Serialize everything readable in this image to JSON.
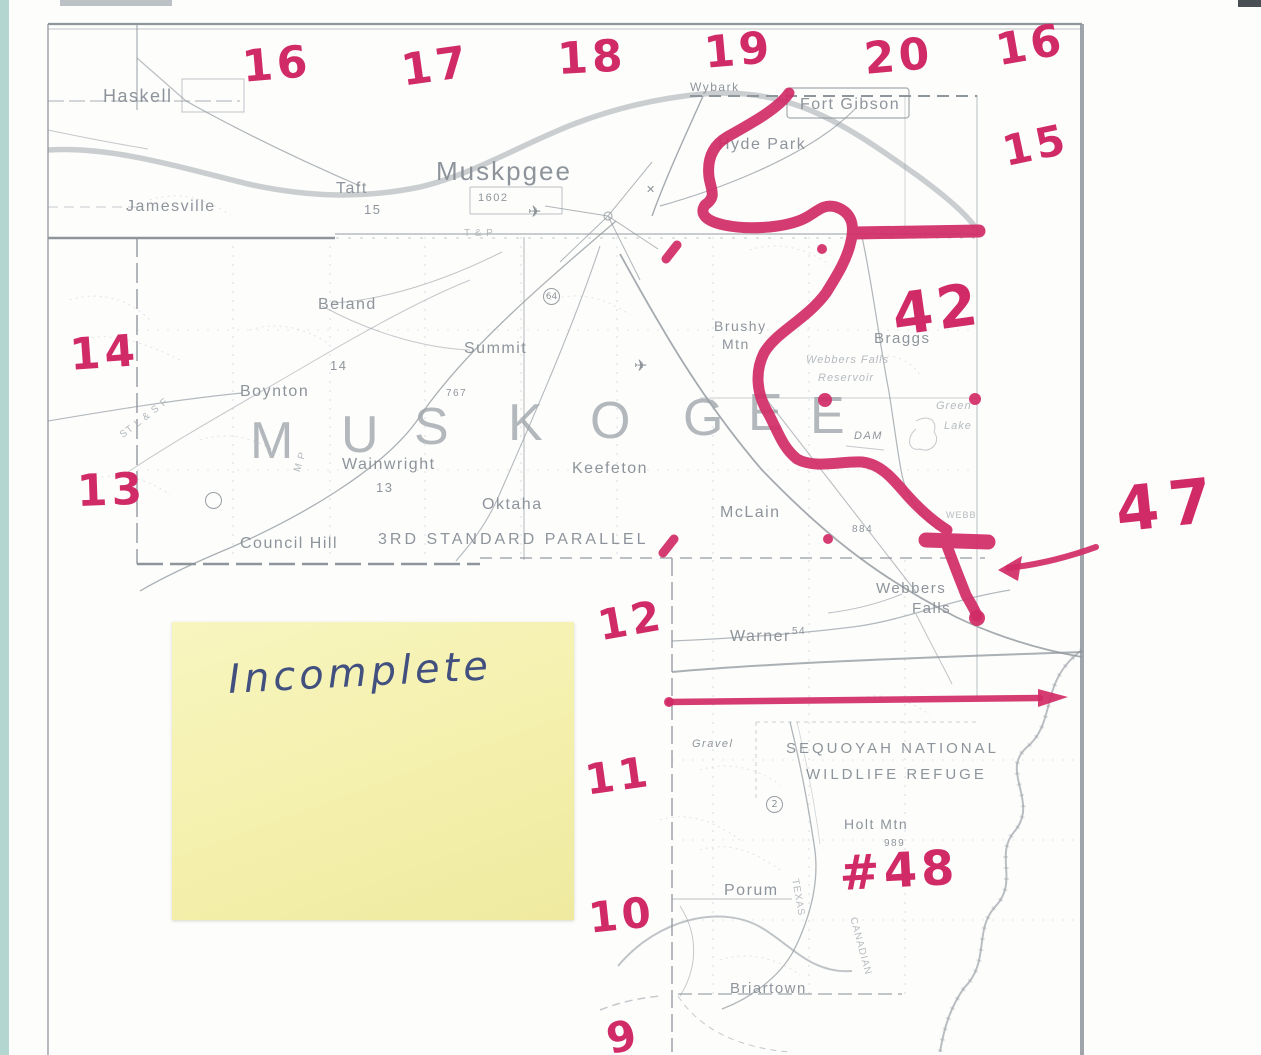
{
  "page": {
    "description": "Scanned Muskogee County Oklahoma highway map with red handwritten township/range numbers and a red marker trace of the Arkansas River navigation channel",
    "sticky_note": {
      "text": "Incomplete"
    }
  },
  "colors": {
    "marker_red": "#d02b66",
    "map_gray": "#8e959b",
    "note_yellow": "#f4f0ac",
    "ink_blue": "#41507f",
    "scanner_teal": "#b4d6d0"
  },
  "map": {
    "county_letters": [
      {
        "ch": "M",
        "x": 250,
        "y": 411
      },
      {
        "ch": "U",
        "x": 341,
        "y": 405
      },
      {
        "ch": "S",
        "x": 414,
        "y": 397
      },
      {
        "ch": "K",
        "x": 508,
        "y": 393
      },
      {
        "ch": "O",
        "x": 590,
        "y": 391
      },
      {
        "ch": "G",
        "x": 683,
        "y": 388
      },
      {
        "ch": "E",
        "x": 748,
        "y": 383
      },
      {
        "ch": "E",
        "x": 810,
        "y": 386
      }
    ],
    "towns": [
      {
        "label": "Haskell",
        "x": 103,
        "y": 86,
        "size": 18
      },
      {
        "label": "Jamesville",
        "x": 126,
        "y": 198,
        "size": 16
      },
      {
        "label": "Taft",
        "x": 336,
        "y": 180,
        "size": 16
      },
      {
        "label": "15",
        "x": 364,
        "y": 202,
        "size": 13
      },
      {
        "label": "Muskpgee",
        "x": 436,
        "y": 156,
        "size": 26,
        "spacing": 2
      },
      {
        "label": "1602",
        "x": 478,
        "y": 192,
        "size": 11
      },
      {
        "label": "Wybark",
        "x": 690,
        "y": 80,
        "size": 12
      },
      {
        "label": "Fort Gibson",
        "x": 800,
        "y": 96,
        "size": 16
      },
      {
        "label": "Hyde Park",
        "x": 718,
        "y": 136,
        "size": 16
      },
      {
        "label": "Beland",
        "x": 318,
        "y": 296,
        "size": 16
      },
      {
        "label": "14",
        "x": 330,
        "y": 358,
        "size": 13
      },
      {
        "label": "Summit",
        "x": 464,
        "y": 340,
        "size": 16
      },
      {
        "label": "767",
        "x": 446,
        "y": 388,
        "size": 10
      },
      {
        "label": "Boynton",
        "x": 240,
        "y": 383,
        "size": 16
      },
      {
        "label": "Wainwright",
        "x": 342,
        "y": 456,
        "size": 16
      },
      {
        "label": "13",
        "x": 376,
        "y": 480,
        "size": 13
      },
      {
        "label": "Keefeton",
        "x": 572,
        "y": 460,
        "size": 16
      },
      {
        "label": "Oktaha",
        "x": 482,
        "y": 496,
        "size": 16
      },
      {
        "label": "McLain",
        "x": 720,
        "y": 504,
        "size": 16
      },
      {
        "label": "884",
        "x": 852,
        "y": 524,
        "size": 10
      },
      {
        "label": "Council Hill",
        "x": 240,
        "y": 535,
        "size": 16
      },
      {
        "label": "3RD STANDARD PARALLEL",
        "x": 378,
        "y": 531,
        "size": 16,
        "spacing": 3
      },
      {
        "label": "Brushy",
        "x": 714,
        "y": 318,
        "size": 14
      },
      {
        "label": "Mtn",
        "x": 722,
        "y": 336,
        "size": 14
      },
      {
        "label": "Braggs",
        "x": 874,
        "y": 330,
        "size": 15
      },
      {
        "label": "DAM",
        "x": 854,
        "y": 430,
        "size": 11,
        "italic": true
      },
      {
        "label": "Webbers",
        "x": 876,
        "y": 580,
        "size": 15
      },
      {
        "label": "Falls",
        "x": 912,
        "y": 600,
        "size": 15
      },
      {
        "label": "Warner",
        "x": 730,
        "y": 628,
        "size": 16
      },
      {
        "label": "54",
        "x": 792,
        "y": 626,
        "size": 10
      },
      {
        "label": "SEQUOYAH NATIONAL",
        "x": 786,
        "y": 740,
        "size": 15,
        "spacing": 3
      },
      {
        "label": "WILDLIFE REFUGE",
        "x": 806,
        "y": 766,
        "size": 15,
        "spacing": 3
      },
      {
        "label": "Holt Mtn",
        "x": 844,
        "y": 816,
        "size": 14
      },
      {
        "label": "989",
        "x": 884,
        "y": 838,
        "size": 10
      },
      {
        "label": "Porum",
        "x": 724,
        "y": 882,
        "size": 16
      },
      {
        "label": "Briartown",
        "x": 730,
        "y": 980,
        "size": 15
      },
      {
        "label": "Gravel",
        "x": 692,
        "y": 738,
        "size": 11,
        "italic": true
      }
    ],
    "faint_labels": [
      {
        "label": "T & P",
        "x": 464,
        "y": 228,
        "size": 10
      },
      {
        "label": "M P",
        "x": 292,
        "y": 470,
        "size": 10,
        "rot": -72
      },
      {
        "label": "ST L & S F",
        "x": 118,
        "y": 432,
        "size": 10,
        "rot": -38
      },
      {
        "label": "Webbers Falls",
        "x": 806,
        "y": 354,
        "size": 11,
        "italic": true
      },
      {
        "label": "Reservoir",
        "x": 818,
        "y": 372,
        "size": 11,
        "italic": true
      },
      {
        "label": "Green",
        "x": 936,
        "y": 400,
        "size": 11,
        "italic": true
      },
      {
        "label": "Lake",
        "x": 944,
        "y": 420,
        "size": 11,
        "italic": true
      },
      {
        "label": "WEBB",
        "x": 946,
        "y": 510,
        "size": 9
      },
      {
        "label": "TEXAS",
        "x": 800,
        "y": 878,
        "size": 10,
        "rot": 80
      },
      {
        "label": "CANADIAN",
        "x": 858,
        "y": 916,
        "size": 10,
        "rot": 75
      }
    ],
    "symbols": [
      {
        "glyph": "✈",
        "x": 528,
        "y": 202,
        "size": 16
      },
      {
        "glyph": "✕",
        "x": 646,
        "y": 183,
        "size": 11
      },
      {
        "glyph": "✈",
        "x": 634,
        "y": 356,
        "size": 16
      },
      {
        "glyph": "64",
        "x": 543,
        "y": 288,
        "size": 9,
        "circle": true
      },
      {
        "glyph": "2",
        "x": 766,
        "y": 796,
        "size": 10,
        "circle": true
      },
      {
        "glyph": "",
        "x": 205,
        "y": 492,
        "size": 11,
        "circle": true
      }
    ]
  },
  "annotations": {
    "red_numbers": [
      {
        "text": "16",
        "x": 240,
        "y": 42,
        "size": 44,
        "rot": -5
      },
      {
        "text": "17",
        "x": 398,
        "y": 46,
        "size": 44,
        "rot": -8
      },
      {
        "text": "18",
        "x": 556,
        "y": 34,
        "size": 44,
        "rot": -3
      },
      {
        "text": "19",
        "x": 702,
        "y": 28,
        "size": 44,
        "rot": -5
      },
      {
        "text": "20",
        "x": 862,
        "y": 34,
        "size": 44,
        "rot": -5
      },
      {
        "text": "16",
        "x": 992,
        "y": 26,
        "size": 44,
        "rot": -10
      },
      {
        "text": "15",
        "x": 998,
        "y": 128,
        "size": 42,
        "rot": -12
      },
      {
        "text": "14",
        "x": 68,
        "y": 330,
        "size": 44,
        "rot": -4
      },
      {
        "text": "13",
        "x": 76,
        "y": 466,
        "size": 44,
        "rot": -2
      },
      {
        "text": "12",
        "x": 594,
        "y": 602,
        "size": 42,
        "rot": -10
      },
      {
        "text": "11",
        "x": 582,
        "y": 756,
        "size": 42,
        "rot": -8
      },
      {
        "text": "10",
        "x": 586,
        "y": 894,
        "size": 42,
        "rot": -6
      },
      {
        "text": "9",
        "x": 602,
        "y": 1016,
        "size": 42,
        "rot": -12
      },
      {
        "text": "42",
        "x": 888,
        "y": 282,
        "size": 58,
        "rot": -8,
        "bold": true
      },
      {
        "text": "47",
        "x": 1112,
        "y": 474,
        "size": 62,
        "rot": -6,
        "bold": true,
        "spacing": 10
      },
      {
        "text": "#48",
        "x": 838,
        "y": 846,
        "size": 48,
        "rot": -3,
        "bold": true
      }
    ],
    "marker_shapes": [
      "river-trace",
      "lock-bar",
      "section-line-north",
      "section-line-south-with-arrowhead",
      "arrow-from-47-to-lock",
      "small-red-ticks-and-dots"
    ]
  }
}
